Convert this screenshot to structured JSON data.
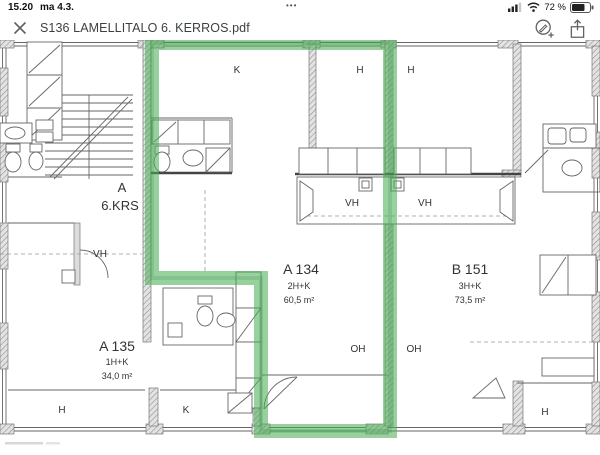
{
  "status_bar": {
    "time": "15.20",
    "date": "ma 4.3.",
    "center_dots": "•••",
    "battery": "72 %"
  },
  "toolbar": {
    "title": "S136 LAMELLITALO 6. KERROS.pdf"
  },
  "plan": {
    "highlight_color": "#57b75e",
    "labels": [
      {
        "t": "K",
        "x": 237,
        "y": 33,
        "s": "sm"
      },
      {
        "t": "H",
        "x": 360,
        "y": 33,
        "s": "sm"
      },
      {
        "t": "H",
        "x": 411,
        "y": 33,
        "s": "sm"
      },
      {
        "t": "A",
        "x": 122,
        "y": 152,
        "s": "md"
      },
      {
        "t": "6.KRS",
        "x": 120,
        "y": 170,
        "s": "md"
      },
      {
        "t": "VH",
        "x": 100,
        "y": 217,
        "s": "sm"
      },
      {
        "t": "VH",
        "x": 352,
        "y": 166,
        "s": "sm"
      },
      {
        "t": "VH",
        "x": 425,
        "y": 166,
        "s": "sm"
      },
      {
        "t": "A 135",
        "x": 117,
        "y": 311,
        "s": "lg"
      },
      {
        "t": "1H+K",
        "x": 117,
        "y": 325,
        "s": "xs"
      },
      {
        "t": "34,0 m²",
        "x": 117,
        "y": 339,
        "s": "xs"
      },
      {
        "t": "A 134",
        "x": 301,
        "y": 234,
        "s": "lg"
      },
      {
        "t": "2H+K",
        "x": 299,
        "y": 249,
        "s": "xs"
      },
      {
        "t": "60,5 m²",
        "x": 299,
        "y": 263,
        "s": "xs"
      },
      {
        "t": "B 151",
        "x": 470,
        "y": 234,
        "s": "lg"
      },
      {
        "t": "3H+K",
        "x": 470,
        "y": 249,
        "s": "xs"
      },
      {
        "t": "73,5 m²",
        "x": 470,
        "y": 263,
        "s": "xs"
      },
      {
        "t": "OH",
        "x": 358,
        "y": 312,
        "s": "sm"
      },
      {
        "t": "OH",
        "x": 414,
        "y": 312,
        "s": "sm"
      },
      {
        "t": "H",
        "x": 62,
        "y": 373,
        "s": "sm"
      },
      {
        "t": "K",
        "x": 186,
        "y": 373,
        "s": "sm"
      },
      {
        "t": "H",
        "x": 545,
        "y": 375,
        "s": "sm"
      }
    ]
  }
}
